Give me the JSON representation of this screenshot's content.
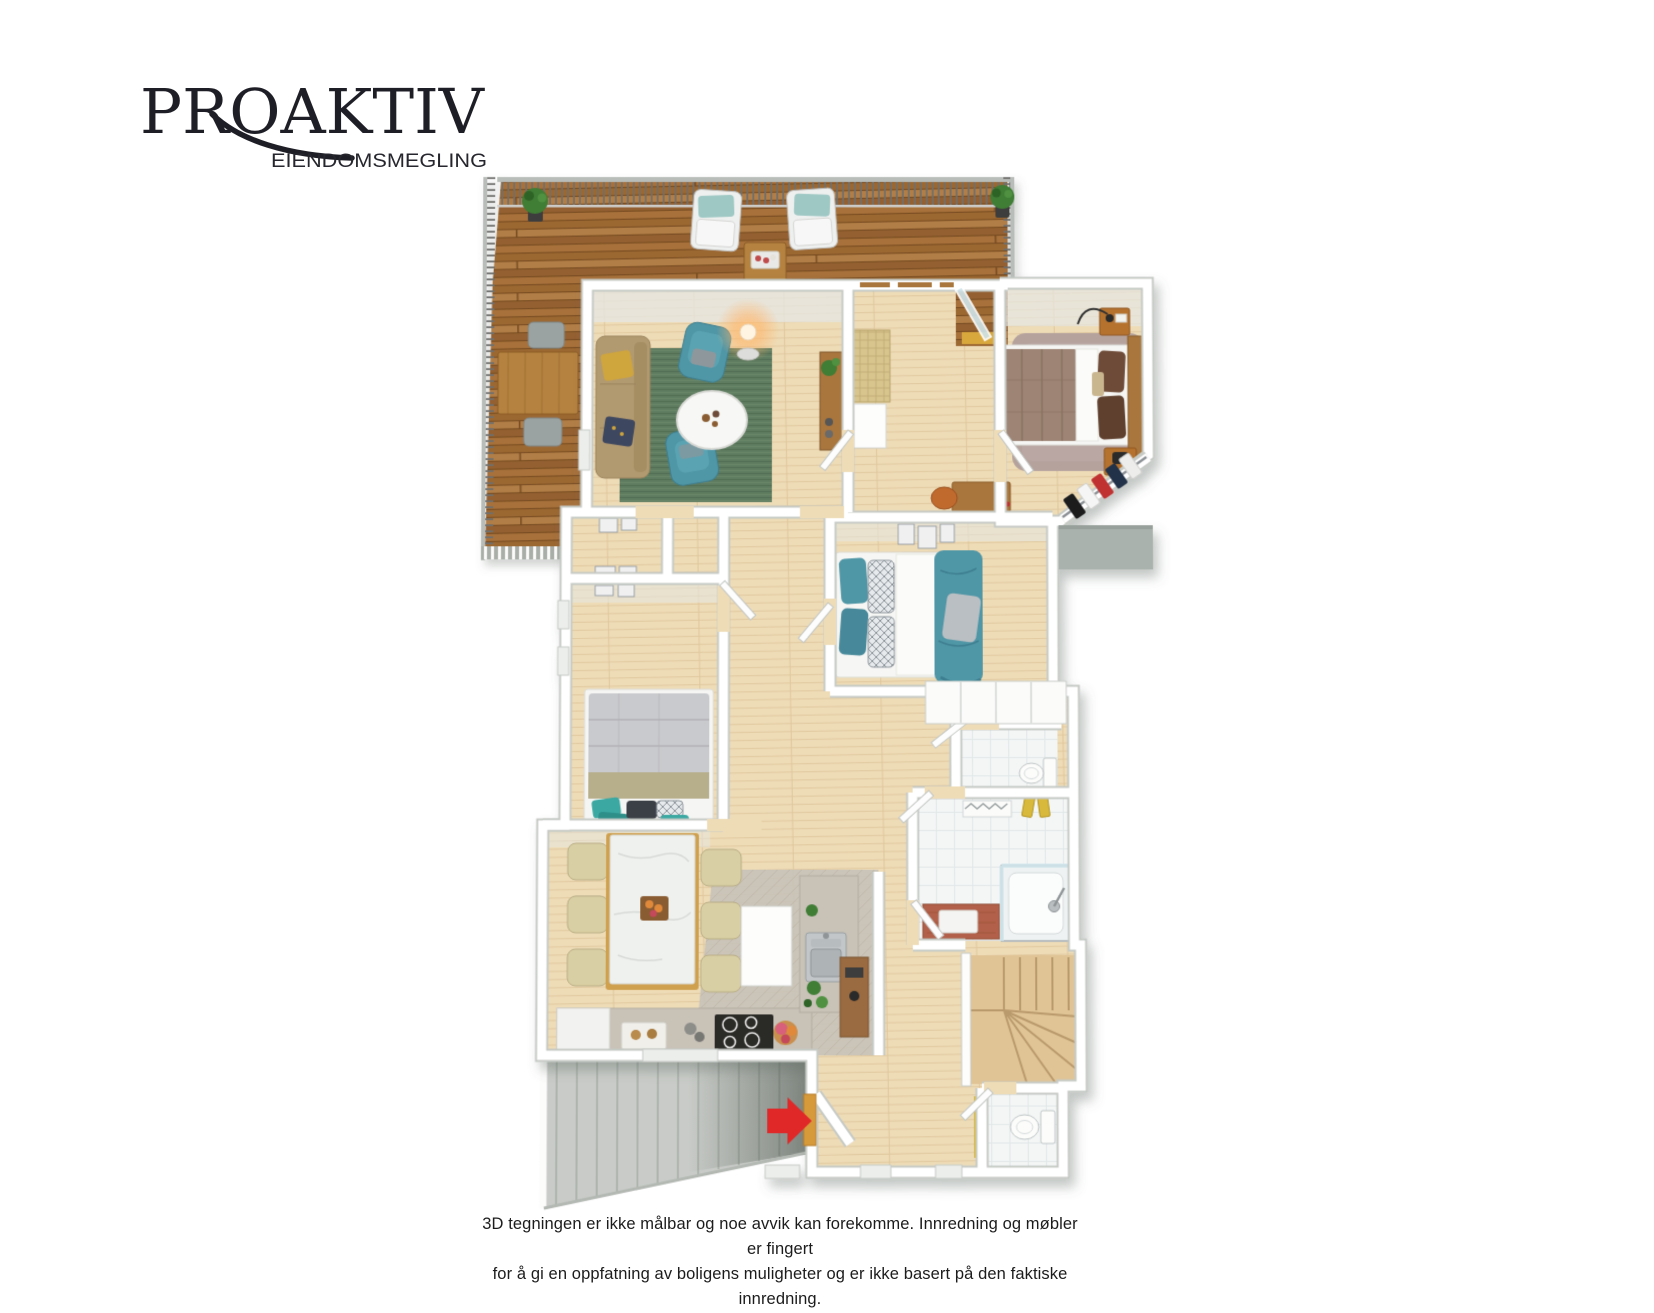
{
  "brand": {
    "name": "PROAKTIV",
    "subtitle": "EIENDOMSMEGLING",
    "color": "#1e1e26"
  },
  "disclaimer": {
    "line1": "3D tegningen er ikke målbar og noe avvik kan forekomme. Innredning og møbler er fingert",
    "line2": "for å gi en oppfatning av boligens muligheter og er ikke basert på den faktiske innredning.",
    "color": "#1c1c1c"
  },
  "floorplan": {
    "view": "3d-top-down-render",
    "colors": {
      "deck": "#a26d37",
      "deckDark": "#73491f",
      "floor": "#eedcb7",
      "floorLine": "#e0c89f",
      "wall": "#ffffff",
      "wallEdge": "#c6cac5",
      "wallFace": "#e6e7e4",
      "rug": "#5e7b60",
      "teal": "#4f96a6",
      "sofa": "#b29a70",
      "pillowYellow": "#cfa53c",
      "marble": "#eff1ef",
      "chairBeige": "#d9cfa4",
      "woodGold": "#cfa04e",
      "woodMid": "#a9763d",
      "counter": "#c8c2b7",
      "stove": "#2b2a28",
      "steel": "#b7bcbe",
      "tile": "#f4f6f6",
      "terracotta": "#b2614a",
      "towel": "#d9b93b",
      "mauve": "#b5a29d",
      "taupe": "#9d8475",
      "brownPillow": "#6e4c38",
      "grayBed": "#c9cacd",
      "blanket": "#b7ae8c",
      "extStair": "#c8cbc7",
      "roofGray": "#a9b2ad",
      "door": "#d79a3b",
      "arrow": "#e02828",
      "glass": "#cfe4ea",
      "plant": "#3f7d35",
      "pot": "#3c3c3c",
      "lampGlow": "#ffb468"
    },
    "elements": [
      "terrace-deck",
      "terrace-railing",
      "potted-plant",
      "outdoor-dining-table",
      "outdoor-chair",
      "lounge-chair",
      "outdoor-coffee-table",
      "living-room-rug",
      "sofa",
      "armchair",
      "floor-lamp",
      "round-coffee-table",
      "console-table",
      "rattan-bench",
      "double-bed",
      "bedside-table",
      "wardrobe-clothes",
      "desk",
      "desk-chair",
      "teal-bed",
      "wall-art",
      "white-wardrobe",
      "single-bed",
      "dining-table",
      "dining-chair",
      "kitchen-counter",
      "cooktop",
      "kitchen-sink",
      "flower-vase",
      "shower",
      "bathroom-vanity",
      "toilet",
      "bath-mat",
      "towels",
      "interior-staircase",
      "exterior-staircase",
      "entrance-door",
      "entrance-arrow",
      "hall-cabinet",
      "sideboard"
    ]
  }
}
